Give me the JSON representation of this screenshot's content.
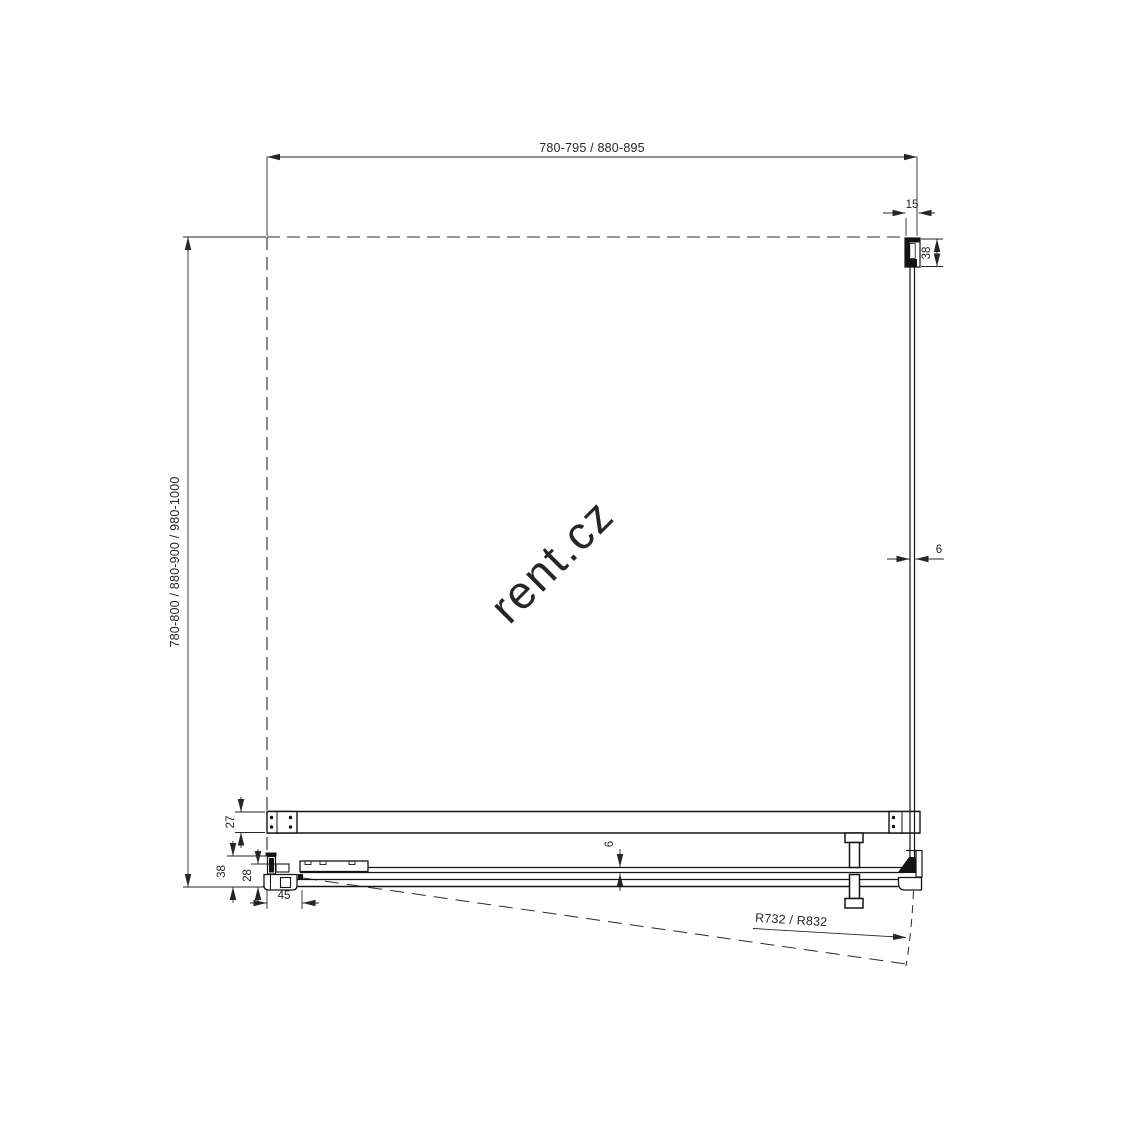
{
  "watermark": {
    "text": "rent.cz",
    "color": "#e3e3e3"
  },
  "drawing": {
    "type": "technical-plan-view",
    "line_color": "#141414",
    "dim_color": "#262626",
    "labels": {
      "top_width": "780-795 / 880-895",
      "left_depth": "780-800 / 880-900 / 980-1000",
      "wall_profile_width": "15",
      "wall_profile_depth": "38",
      "side_glass_thickness": "6",
      "top_rail_depth": "27",
      "sill_depth": "38",
      "door_rail_depth": "28",
      "hinge_offset": "45",
      "door_glass_thickness": "6",
      "door_swing_radius": "R732 / R832"
    }
  }
}
